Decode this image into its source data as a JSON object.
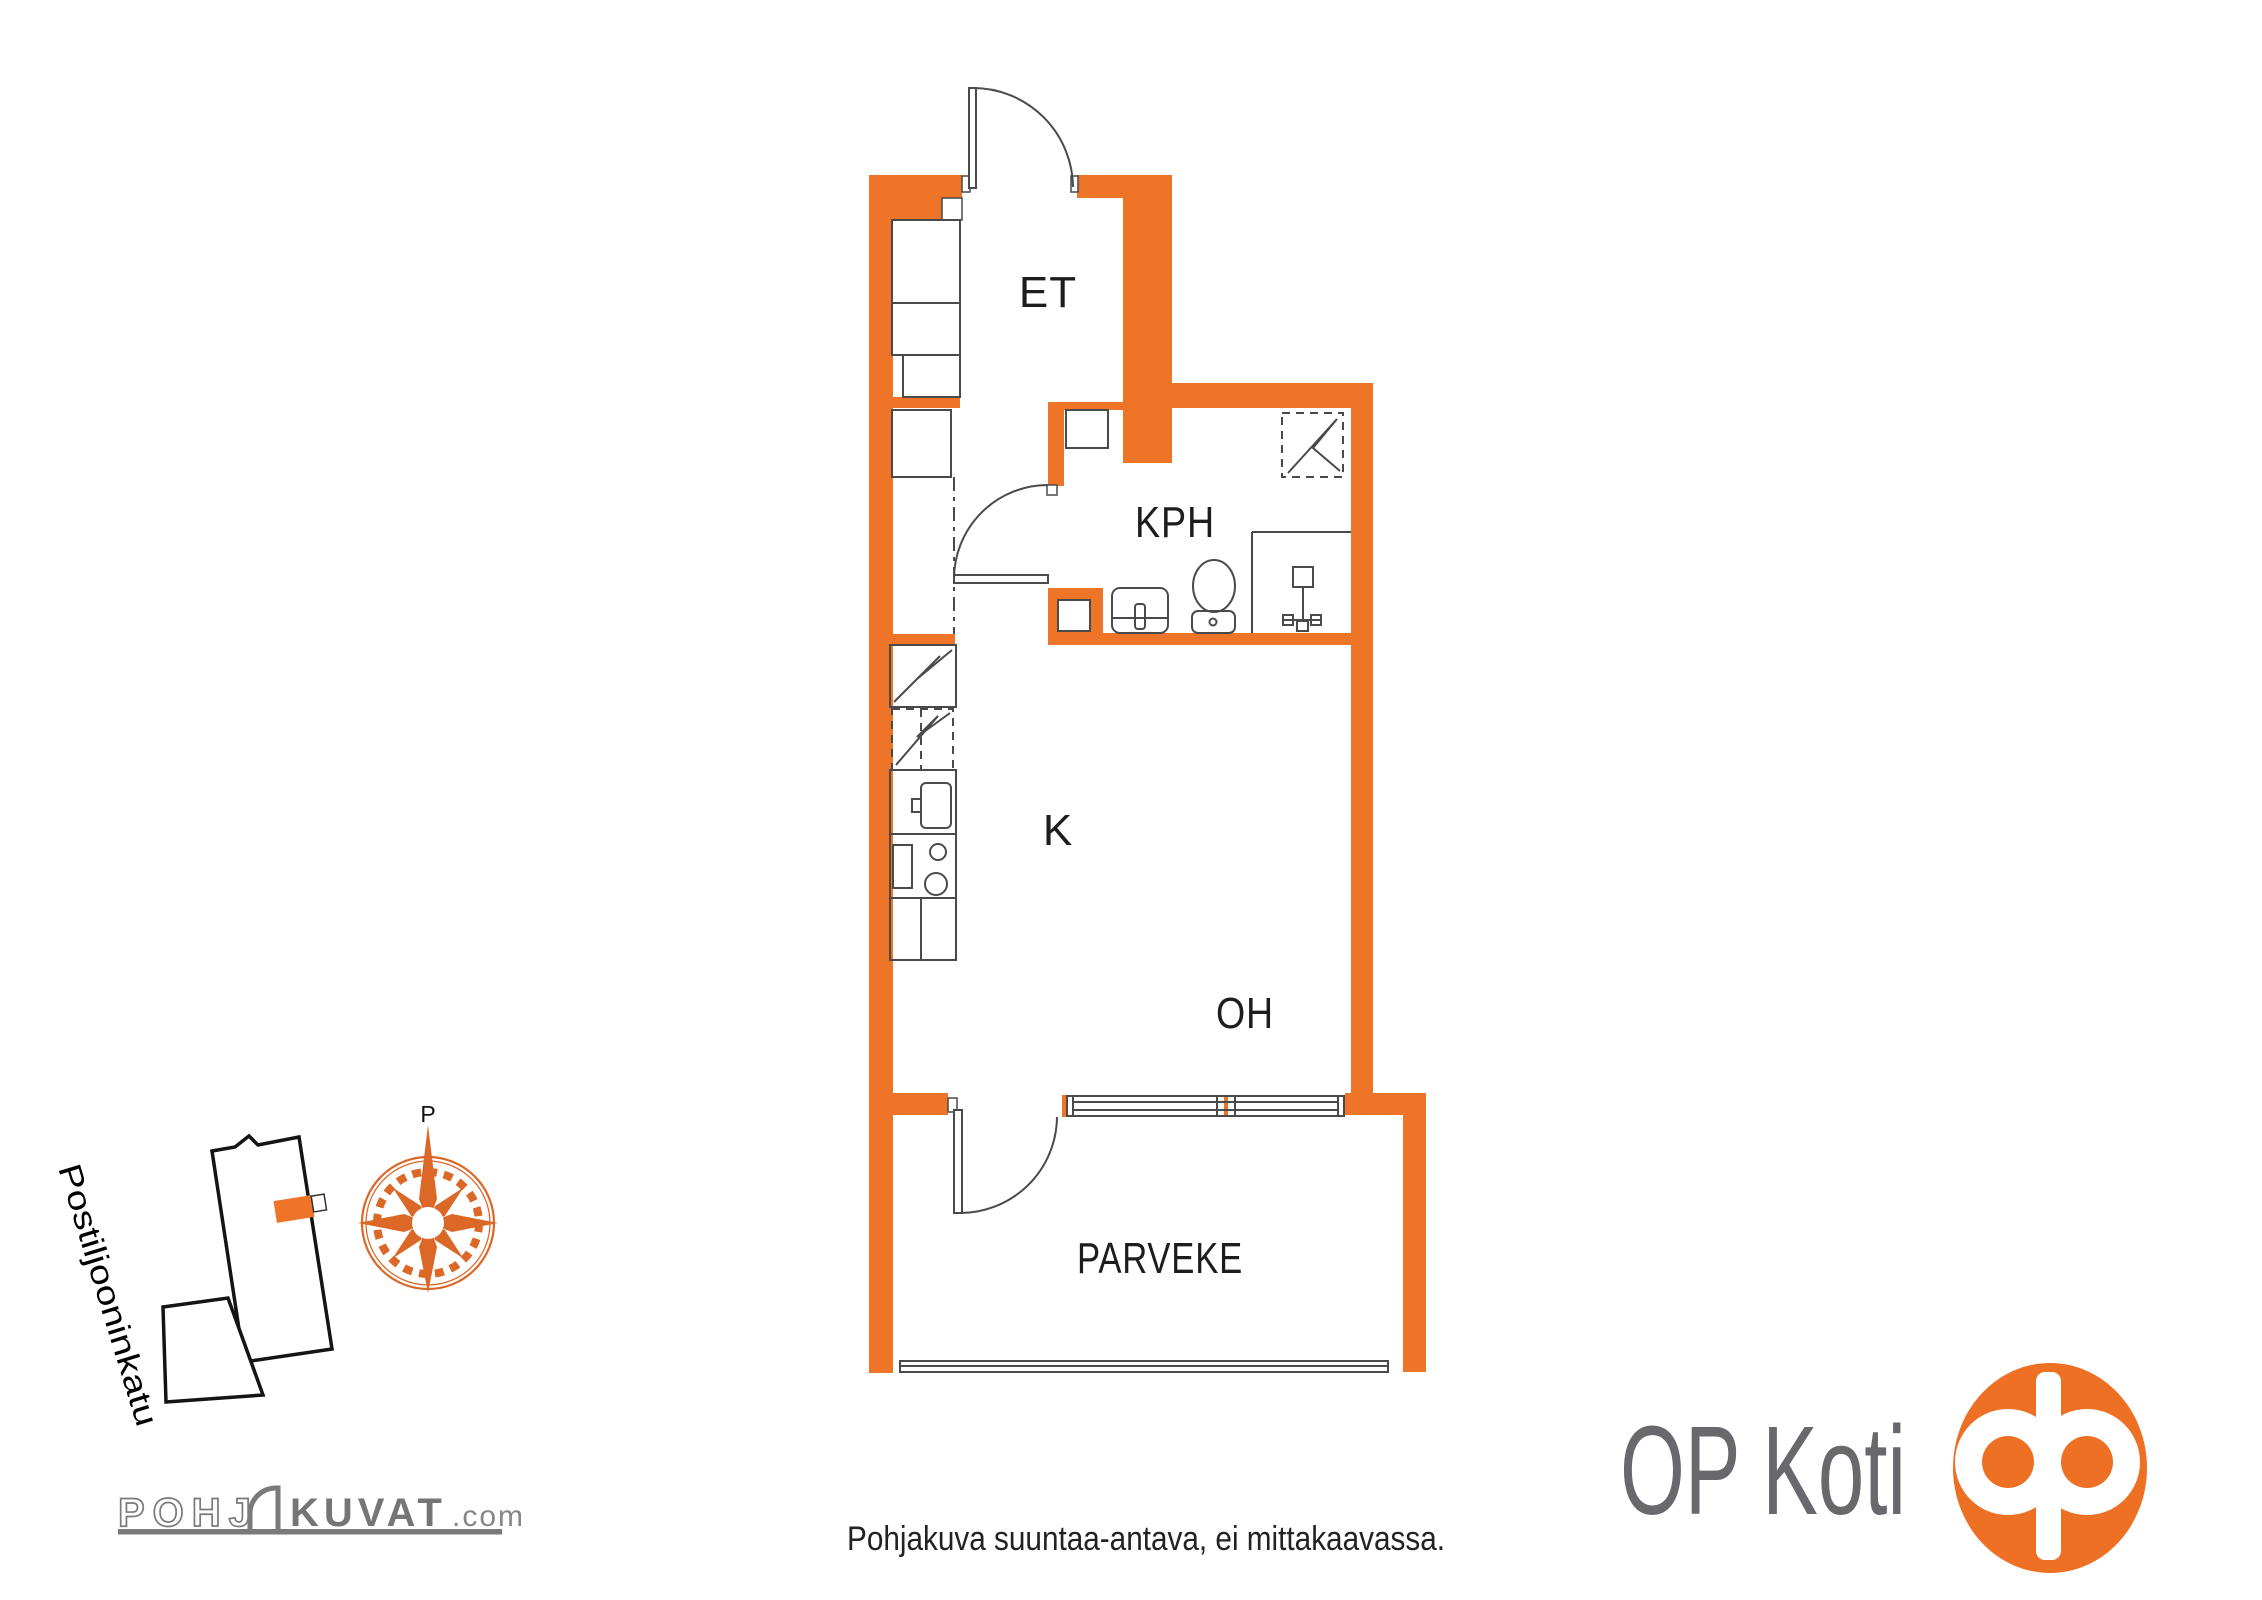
{
  "plan": {
    "rooms": [
      {
        "id": "et",
        "label": "ET"
      },
      {
        "id": "kph",
        "label": "KPH"
      },
      {
        "id": "k",
        "label": "K"
      },
      {
        "id": "oh",
        "label": "OH"
      },
      {
        "id": "parveke",
        "label": "PARVEKE"
      }
    ]
  },
  "compass": {
    "north_label": "P"
  },
  "site_map": {
    "street_name": "Postiljooninkatu"
  },
  "branding": {
    "pohjakuvat": {
      "part1": "POHJ",
      "part2": "KUVAT",
      "suffix": ".com"
    },
    "op_koti": "OP Koti"
  },
  "footer": {
    "disclaimer": "Pohjakuva suuntaa-antava, ei mittakaavassa."
  },
  "colors": {
    "wall_orange": "#EE7428",
    "compass_orange": "#DB6827",
    "op_orange": "#ED7024",
    "fixture_gray": "#4a4a4a",
    "logo_gray": "#757575",
    "brand_text_gray": "#68686D"
  }
}
